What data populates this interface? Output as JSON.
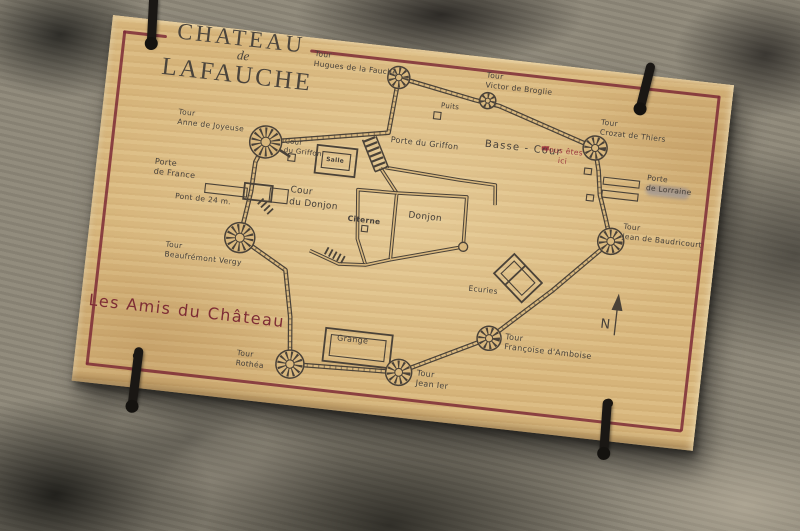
{
  "board": {
    "title_line1": "CHATEAU",
    "title_line2": "de",
    "title_line3": "LAFAUCHE",
    "footer_text": "Les Amis du Château"
  },
  "colors": {
    "wood": "#d9b87e",
    "ink": "#4a4238",
    "frame_red": "#7d2b36",
    "accent_red": "#9c3a40",
    "stone_grey": "#8e8879"
  },
  "map": {
    "labels": [
      {
        "id": "tour-hugues",
        "text": "Tour\nHugues de la Fauche",
        "x": 205,
        "y": 11,
        "size": 7.5
      },
      {
        "id": "tour-victor",
        "text": "Tour\nVictor de Broglie",
        "x": 378,
        "y": 13,
        "size": 7.5
      },
      {
        "id": "puits",
        "text": "Puits",
        "x": 336,
        "y": 49,
        "size": 7
      },
      {
        "id": "tour-crozat",
        "text": "Tour\nCrozat de Thiers",
        "x": 497,
        "y": 47,
        "size": 7.5
      },
      {
        "id": "basse-cour",
        "text": "Basse - Cour",
        "x": 384,
        "y": 80,
        "size": 10,
        "spacing": 1.2
      },
      {
        "id": "vous-etes-ici",
        "text": "Vous êtes\nici",
        "x": 463,
        "y": 80,
        "size": 7.5,
        "color": "#9c3a40",
        "center": true
      },
      {
        "id": "porte-griffon",
        "text": "Porte du Griffon",
        "x": 290,
        "y": 88,
        "size": 8
      },
      {
        "id": "cour-griffon",
        "text": "Cour\ndu Griffon",
        "x": 185,
        "y": 102,
        "size": 7
      },
      {
        "id": "tour-anne",
        "text": "Tour\nAnne de Joyeuse",
        "x": 76,
        "y": 84,
        "size": 7.5
      },
      {
        "id": "porte-lorraine",
        "text": "Porte\nde Lorraine",
        "x": 549,
        "y": 97,
        "size": 7.5
      },
      {
        "id": "porte-france",
        "text": "Porte\nde France",
        "x": 58,
        "y": 136,
        "size": 8
      },
      {
        "id": "cour-donjon",
        "text": "Cour\ndu Donjon",
        "x": 196,
        "y": 149,
        "size": 9
      },
      {
        "id": "donjon",
        "text": "Donjon",
        "x": 316,
        "y": 161,
        "size": 9
      },
      {
        "id": "citerne",
        "text": "Citerne",
        "x": 256,
        "y": 171,
        "size": 7.5,
        "bold": true
      },
      {
        "id": "salle",
        "text": "Salle",
        "x": 228,
        "y": 116,
        "size": 6,
        "bold": true
      },
      {
        "id": "pont",
        "text": "Pont de 24 m.",
        "x": 82,
        "y": 168,
        "size": 7.5
      },
      {
        "id": "tour-baudricourt",
        "text": "Tour\nJean de Baudricourt",
        "x": 531,
        "y": 148,
        "size": 7.5
      },
      {
        "id": "tour-beaufremont",
        "text": "Tour\nBeaufrémont Vergy",
        "x": 78,
        "y": 217,
        "size": 7.5
      },
      {
        "id": "ecuries",
        "text": "Ecuries",
        "x": 384,
        "y": 227,
        "size": 7.5
      },
      {
        "id": "tour-francoise",
        "text": "Tour\nFrançoise d'Amboise",
        "x": 426,
        "y": 271,
        "size": 8
      },
      {
        "id": "tour-jean",
        "text": "Tour\nJean Ier",
        "x": 342,
        "y": 317,
        "size": 8
      },
      {
        "id": "grange",
        "text": "Grange",
        "x": 259,
        "y": 291,
        "size": 8
      },
      {
        "id": "tour-rothea",
        "text": "Tour\nRothéa",
        "x": 161,
        "y": 317,
        "size": 7.5
      },
      {
        "id": "compass-n",
        "text": "N",
        "x": 519,
        "y": 245,
        "size": 13
      }
    ]
  }
}
